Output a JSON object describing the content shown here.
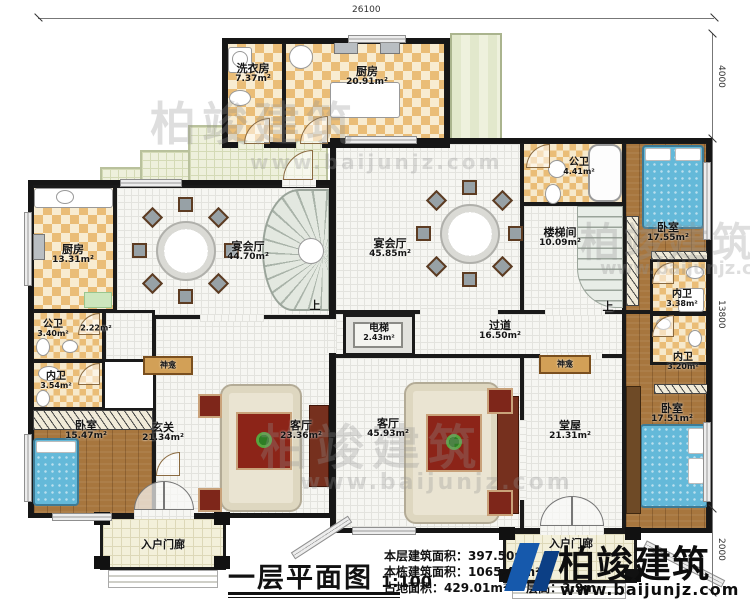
{
  "title": {
    "text": "一层平面图",
    "scale": "1:100"
  },
  "info": {
    "l1_label": "本层建筑面积：",
    "l1_value": "397.50m²",
    "l2_label": "本栋建筑面积：",
    "l2_value": "1065.47m²",
    "l3_label": "占地面积：",
    "l3_value": "429.01m²",
    "l4_label": "层高：",
    "l4_value": "3.9m"
  },
  "logo": {
    "name": "柏竣建筑",
    "url": "www.baijunjz.com"
  },
  "watermark": {
    "cn": "柏竣建筑",
    "url": "www.baijunjz.com"
  },
  "dimensions": {
    "top": "26100",
    "right_top": "4000",
    "right_mid": "13800",
    "right_bottom": "2000"
  },
  "stairs": {
    "up": "上"
  },
  "shrine": {
    "label": "神龛"
  },
  "porch": {
    "label": "入户门廊"
  },
  "rooms": {
    "laundry": {
      "name": "洗衣房",
      "area": "7.37m²"
    },
    "kitchen_top": {
      "name": "厨房",
      "area": "20.91m²"
    },
    "kitchen_left": {
      "name": "厨房",
      "area": "13.31m²"
    },
    "banquet_left": {
      "name": "宴会厅",
      "area": "44.70m²"
    },
    "banquet_right": {
      "name": "宴会厅",
      "area": "45.85m²"
    },
    "pub_bath_right": {
      "name": "公卫",
      "area": "4.41m²"
    },
    "stairwell": {
      "name": "楼梯间",
      "area": "10.09m²"
    },
    "bedroom_top_right": {
      "name": "卧室",
      "area": "17.55m²"
    },
    "inner_bath_338": {
      "name": "内卫",
      "area": "3.38m²"
    },
    "pub_bath_left": {
      "name": "公卫",
      "area": "3.40m²"
    },
    "closet": {
      "area": "2.22m²"
    },
    "inner_bath_354": {
      "name": "内卫",
      "area": "3.54m²"
    },
    "bedroom_left": {
      "name": "卧室",
      "area": "15.47m²"
    },
    "foyer": {
      "name": "玄关",
      "area": "21.34m²"
    },
    "living_left": {
      "name": "客厅",
      "area": "23.36m²"
    },
    "elevator": {
      "name": "电梯",
      "area": "2.43m²"
    },
    "corridor": {
      "name": "过道",
      "area": "16.50m²"
    },
    "inner_bath_320": {
      "name": "内卫",
      "area": "3.20m²"
    },
    "bedroom_bottom_right": {
      "name": "卧室",
      "area": "17.51m²"
    },
    "living_right": {
      "name": "客厅",
      "area": "45.93m²"
    },
    "hall_right": {
      "name": "堂屋",
      "area": "21.31m²"
    }
  },
  "colors": {
    "wall": "#1a1a1a",
    "checker": "#eabd77",
    "wood_floor": "#a7763e",
    "terrace": "#eef0dc",
    "bed_blue": "#64b9d9",
    "rug_red": "#8c2418",
    "logo_blue": "#1659ac"
  }
}
